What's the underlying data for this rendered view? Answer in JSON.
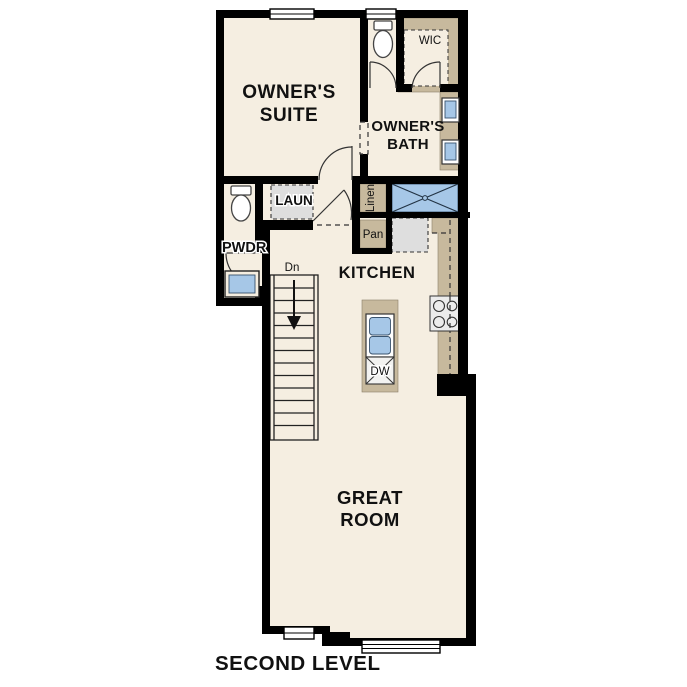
{
  "title": "SECOND LEVEL",
  "rooms": {
    "owners_suite": {
      "line1": "OWNER'S",
      "line2": "SUITE"
    },
    "owners_bath": {
      "line1": "OWNER'S",
      "line2": "BATH"
    },
    "wic": "WIC",
    "laundry": "LAUN",
    "powder": "PWDR",
    "kitchen": "KITCHEN",
    "great_room": {
      "line1": "GREAT",
      "line2": "ROOM"
    },
    "linen": "Linen",
    "pantry": "Pan"
  },
  "annotations": {
    "stairs_direction": "Dn",
    "dishwasher": "DW"
  },
  "colors": {
    "background": "#FFFFFF",
    "floor": "#F5EEE1",
    "wall": "#000000",
    "cabinet_tan": "#C7B99D",
    "fixture_blue": "#A6C7E7",
    "appliance_gray": "#DEDEDE"
  }
}
